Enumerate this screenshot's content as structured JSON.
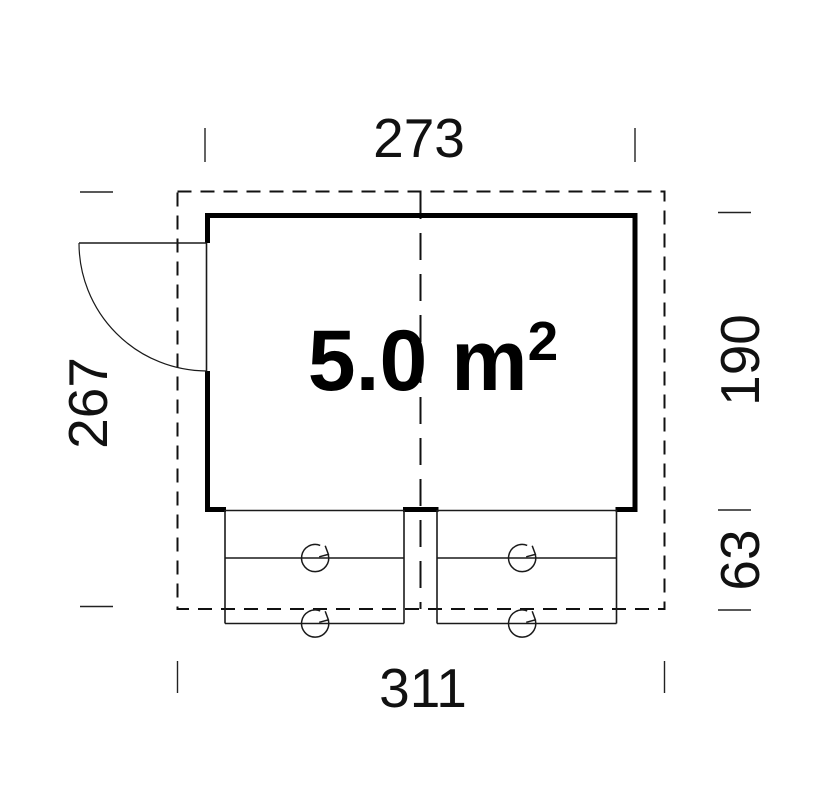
{
  "plan": {
    "type": "floor-plan",
    "area": {
      "value_and_unit": "5.0 m",
      "exponent": "2"
    },
    "dimensions": {
      "top_width": "273",
      "bottom_width": "311",
      "left_depth": "267",
      "right_room_depth": "190",
      "right_terrace_depth": "63"
    },
    "colors": {
      "wall": "#000000",
      "line": "#1a1a1a",
      "background": "#ffffff"
    }
  }
}
